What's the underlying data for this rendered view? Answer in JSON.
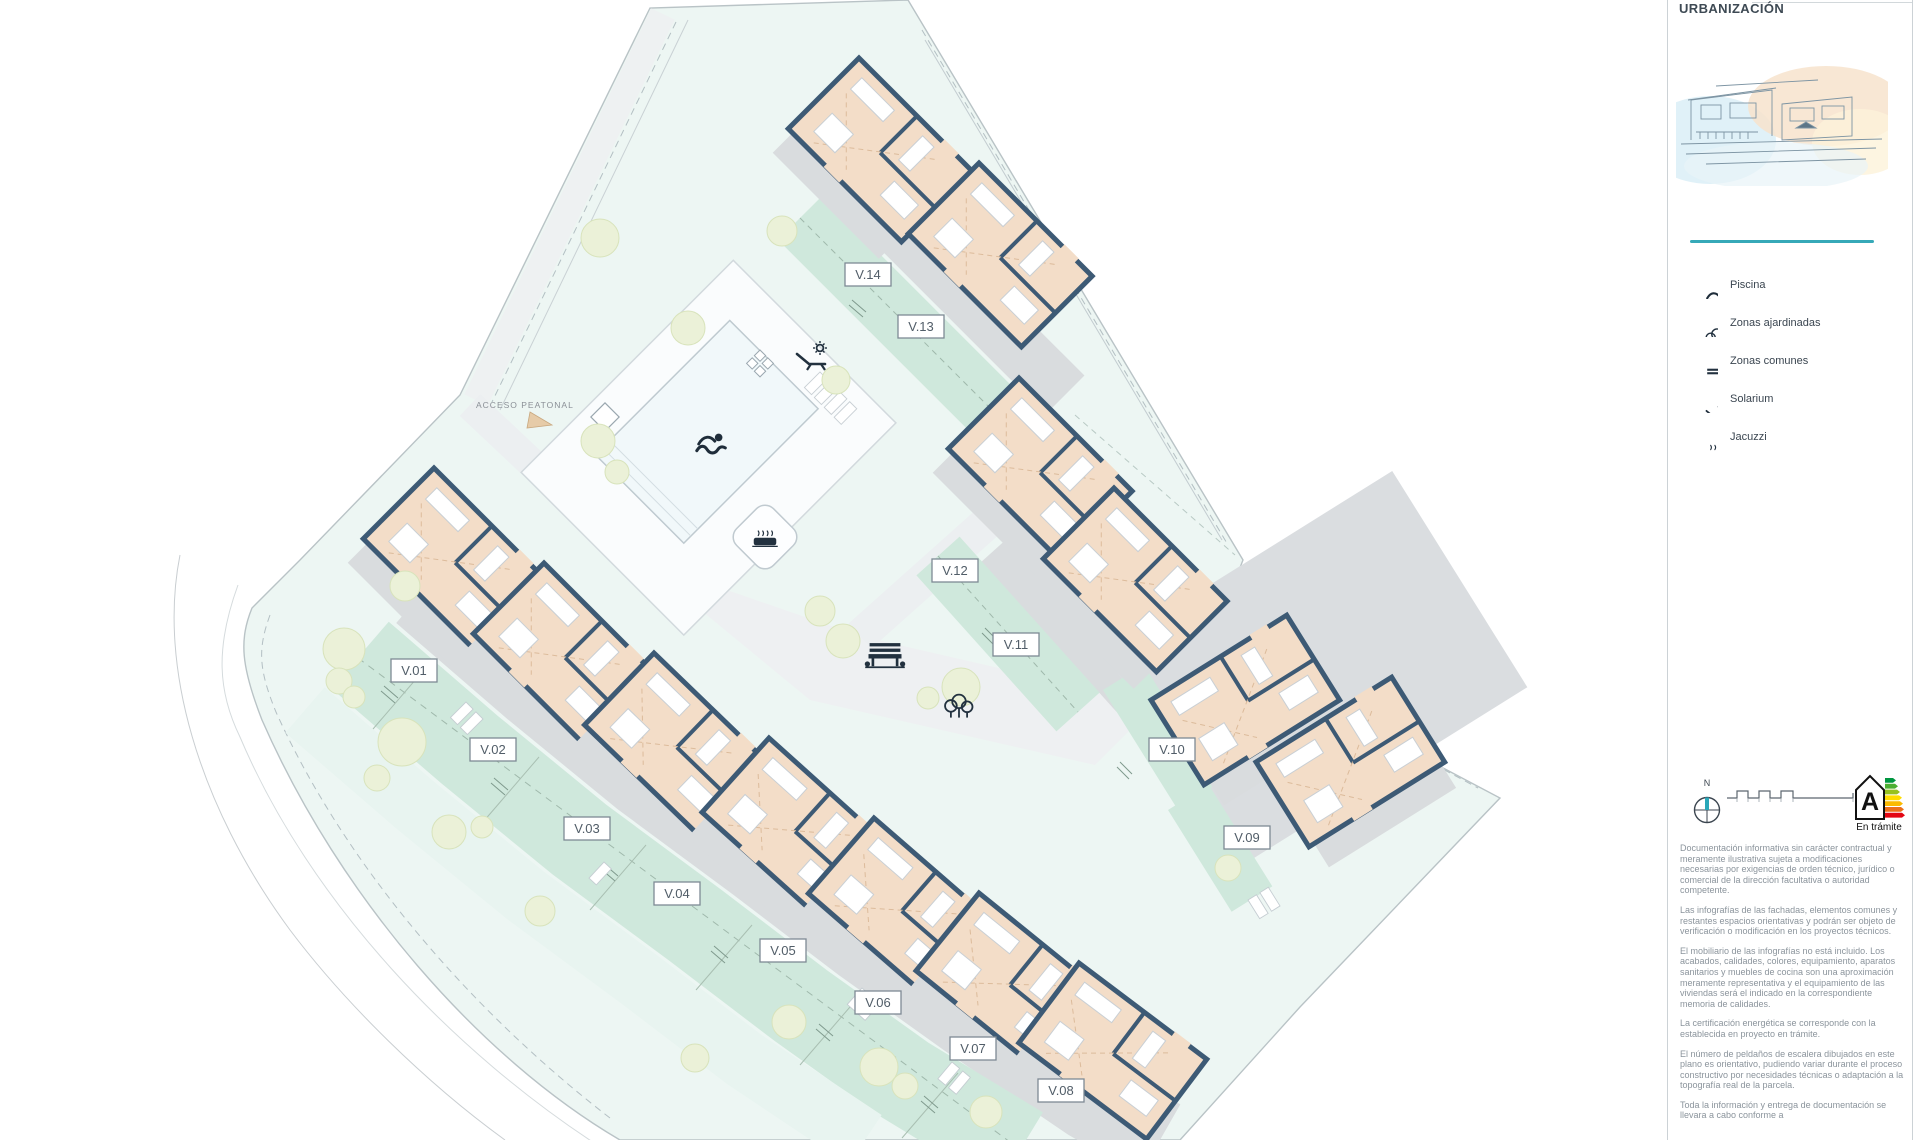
{
  "sidebar": {
    "title": "URBANIZACIÓN",
    "legend": {
      "items": [
        {
          "icon": "swimmer-icon",
          "label": "Piscina"
        },
        {
          "icon": "trees-icon",
          "label": "Zonas ajardinadas"
        },
        {
          "icon": "bench-icon",
          "label": "Zonas comunes"
        },
        {
          "icon": "sun-lounger-icon",
          "label": "Solarium"
        },
        {
          "icon": "jacuzzi-icon",
          "label": "Jacuzzi"
        }
      ]
    },
    "compass": {
      "north_label": "N"
    },
    "energy": {
      "letter": "A",
      "status": "En trámite"
    },
    "disclaimers": [
      "Documentación informativa sin carácter contractual y meramente ilustrativa sujeta a modificaciones necesarias por exigencias de orden técnico, jurídico o comercial de la dirección facultativa o autoridad competente.",
      "Las infografías de las fachadas, elementos comunes y restantes espacios orientativas y podrán ser objeto de verificación o modificación en los proyectos técnicos.",
      "El mobiliario de las infografías no está incluido. Los acabados, calidades, colores, equipamiento, aparatos sanitarios y muebles de cocina son una aproximación meramente representativa y el equipamiento de las viviendas será el indicado en la correspondiente memoria de calidades.",
      "La certificación energética se corresponde con la establecida en proyecto en trámite.",
      "El número de peldaños de escalera dibujados en este plano es orientativo, pudiendo variar durante el proceso constructivo por necesidades técnicas o adaptación a la topografía real de la parcela.",
      "Toda la información y entrega de documentación se llevara a cabo conforme a"
    ]
  },
  "plan": {
    "access_label": "ACCESO PEATONAL",
    "plots": [
      {
        "id": "V.01"
      },
      {
        "id": "V.02"
      },
      {
        "id": "V.03"
      },
      {
        "id": "V.04"
      },
      {
        "id": "V.05"
      },
      {
        "id": "V.06"
      },
      {
        "id": "V.07"
      },
      {
        "id": "V.08"
      },
      {
        "id": "V.09"
      },
      {
        "id": "V.10"
      },
      {
        "id": "V.11"
      },
      {
        "id": "V.12"
      },
      {
        "id": "V.13"
      },
      {
        "id": "V.14"
      }
    ]
  },
  "colors": {
    "accent_teal": "#36a9b8",
    "wall_navy": "#3d5a75",
    "floor_peach": "#f3ddc8",
    "garden_mint": "#cfe8dc",
    "terrace_gray": "#d9dcde",
    "site_tint": "#edf6f3",
    "energy_scale": [
      "#009640",
      "#4caf32",
      "#97c11f",
      "#ffdc00",
      "#fbba00",
      "#ec6f1a",
      "#e30613"
    ]
  }
}
